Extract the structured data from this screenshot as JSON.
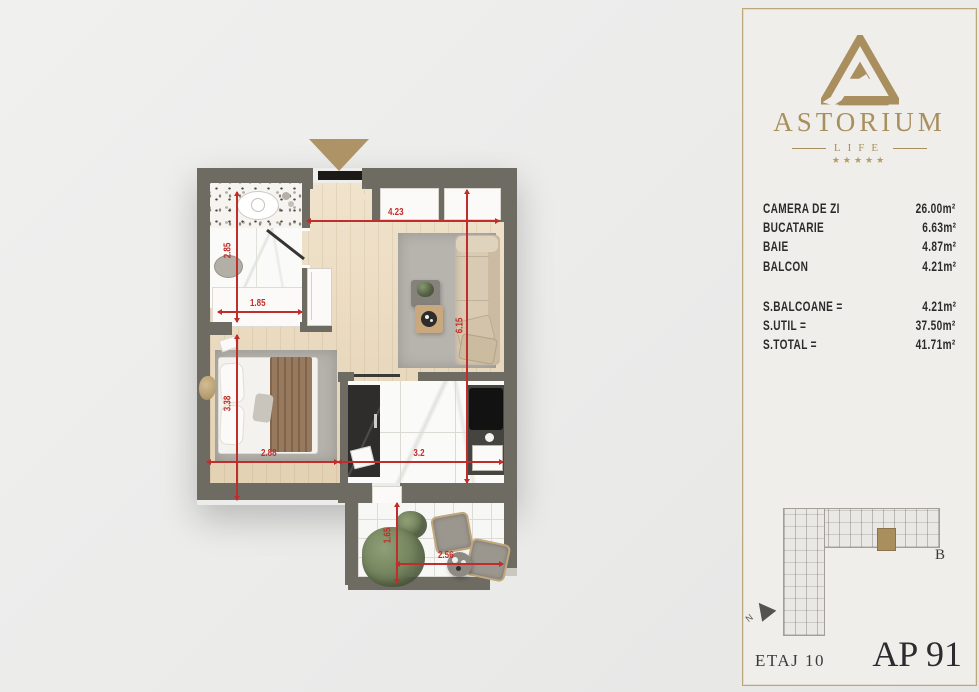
{
  "brand": {
    "name": "ASTORIUM",
    "subname": "LIFE",
    "stars": "★★★★★",
    "accent_gold": "#a8905e"
  },
  "areas": {
    "rooms": [
      {
        "label": "CAMERA DE ZI",
        "value": "26.00m²"
      },
      {
        "label": "BUCATARIE",
        "value": "6.63m²"
      },
      {
        "label": "BAIE",
        "value": "4.87m²"
      },
      {
        "label": "BALCON",
        "value": "4.21m²"
      }
    ],
    "totals": [
      {
        "label": "S.BALCOANE =",
        "value": "4.21m²"
      },
      {
        "label": "S.UTIL =",
        "value": "37.50m²"
      },
      {
        "label": "S.TOTAL =",
        "value": "41.71m²"
      }
    ]
  },
  "minimap": {
    "section_label": "B",
    "compass_label": "N"
  },
  "footer": {
    "floor": "ETAJ 10",
    "apartment": "AP 91"
  },
  "floorplan": {
    "dims": {
      "living_width": "4.23",
      "living_height": "6.15",
      "bath_width": "1.85",
      "bath_height": "2.85",
      "bed_width": "2.88",
      "bed_height": "3.38",
      "kitchen_width": "3.2",
      "balcony_width": "2.56",
      "balcony_height": "1.65"
    },
    "colors": {
      "wall": "#6e6c62",
      "dimension_red": "#bf2e2a",
      "entrance_marker": "#ad9366"
    }
  }
}
